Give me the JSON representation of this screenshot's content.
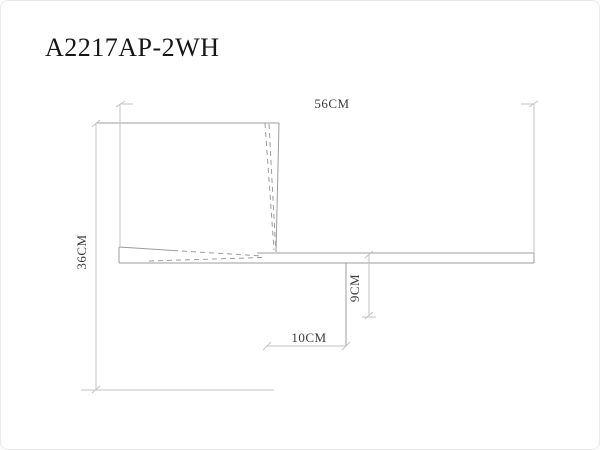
{
  "title": "A2217AP-2WH",
  "dimensions": {
    "width": "56CM",
    "height": "36CM",
    "depth": "9CM",
    "offset": "10CM"
  },
  "colors": {
    "line": "#9c9c9c",
    "dim_line": "#c3c3c3",
    "text": "#3c3c3c",
    "title_text": "#161616",
    "border": "#e9e9e9",
    "background": "#ffffff"
  }
}
